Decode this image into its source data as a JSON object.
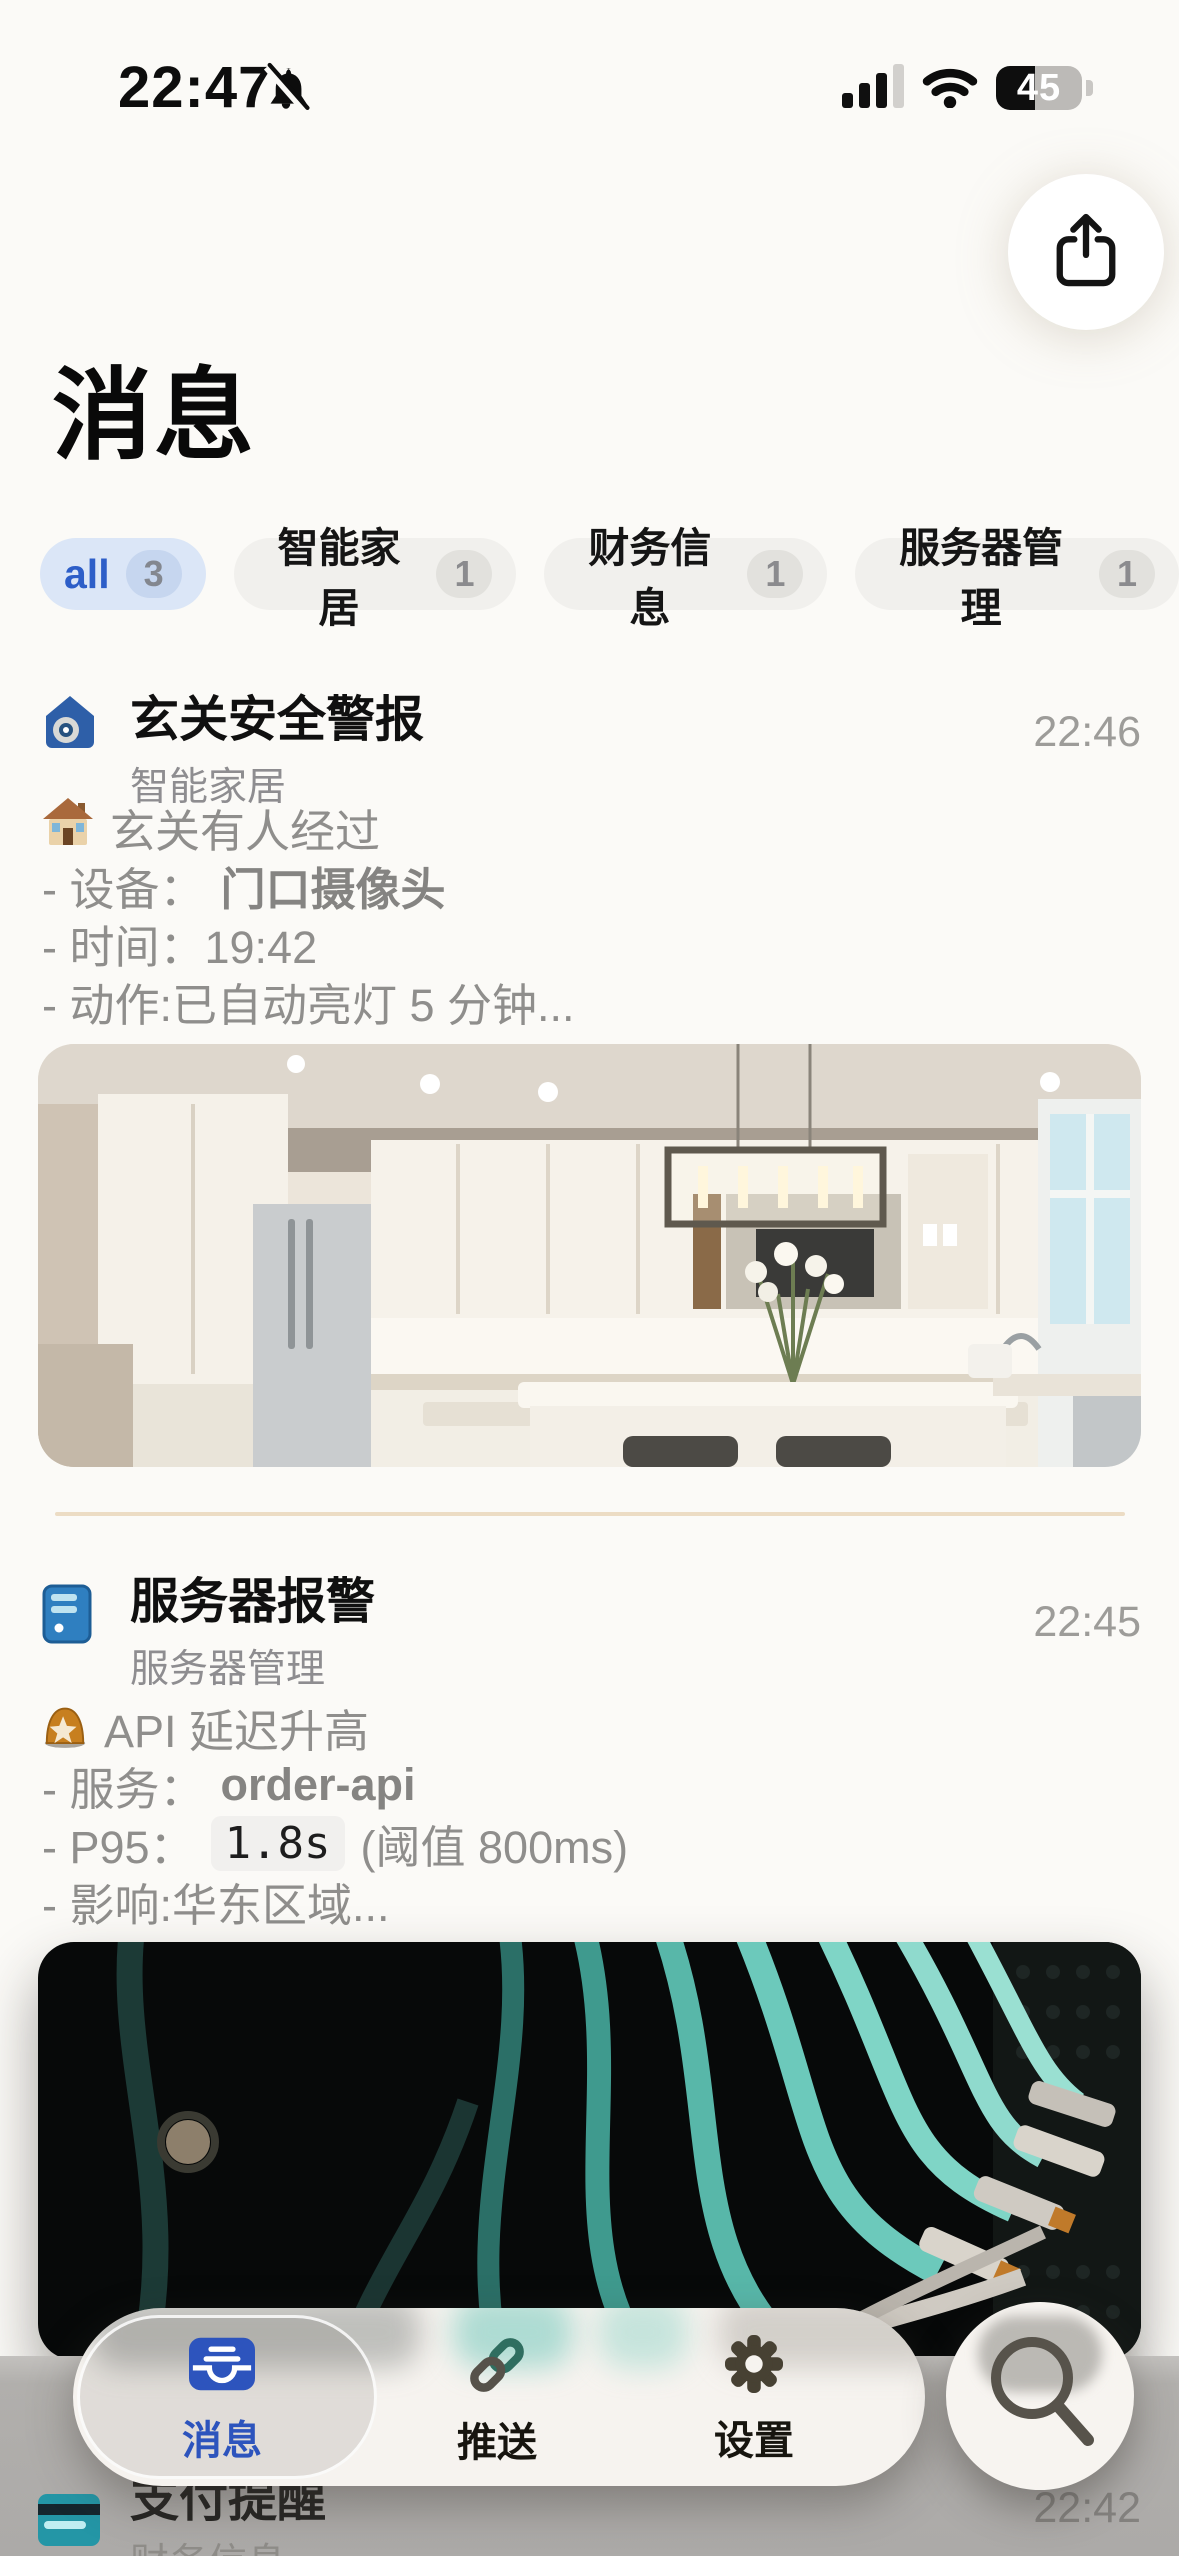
{
  "status_bar": {
    "time": "22:47",
    "battery_percent": "45"
  },
  "page": {
    "title": "消息"
  },
  "filters": {
    "chips": [
      {
        "label": "all",
        "count": "3",
        "active": true
      },
      {
        "label": "智能家居",
        "count": "1",
        "active": false
      },
      {
        "label": "财务信息",
        "count": "1",
        "active": false
      },
      {
        "label": "服务器管理",
        "count": "1",
        "active": false
      }
    ]
  },
  "messages": [
    {
      "title": "玄关安全警报",
      "category": "智能家居",
      "time": "22:46",
      "app_icon": "smart-home-app-icon",
      "line1_icon": "house-emoji",
      "line1": "玄关有人经过",
      "line2_label": "- 设备：",
      "line2_value": "门口摄像头",
      "line3": "- 时间：19:42",
      "line4": "- 动作:已自动亮灯 5 分钟...",
      "photo_icon": "kitchen-photo"
    },
    {
      "title": "服务器报警",
      "category": "服务器管理",
      "time": "22:45",
      "app_icon": "server-app-icon",
      "line1_icon": "siren-emoji",
      "line1": "API 延迟升高",
      "line2_label": "- 服务：",
      "line2_value": "order-api",
      "line3_label": "- P95：",
      "line3_code": "1.8s",
      "line3_suffix": "(阈值 800ms)",
      "line4": "- 影响:华东区域...",
      "photo_icon": "network-cables-photo"
    },
    {
      "title": "支付提醒",
      "category": "财务信息",
      "time": "22:42",
      "app_icon": "credit-card-emoji"
    }
  ],
  "tab_bar": {
    "tabs": [
      {
        "label": "消息",
        "icon": "inbox-icon",
        "active": true
      },
      {
        "label": "推送",
        "icon": "link-icon",
        "active": false
      },
      {
        "label": "设置",
        "icon": "gear-icon",
        "active": false
      }
    ],
    "search_icon": "search-icon"
  },
  "colors": {
    "accent_blue": "#2d54bd",
    "chip_active_bg": "#dbe6f7",
    "chip_active_text": "#2d5ec8",
    "body_text_gray": "#8f8e8c",
    "divider_tan": "#ecdcc4",
    "bottom_scrim_gray": "#acaaa8"
  }
}
